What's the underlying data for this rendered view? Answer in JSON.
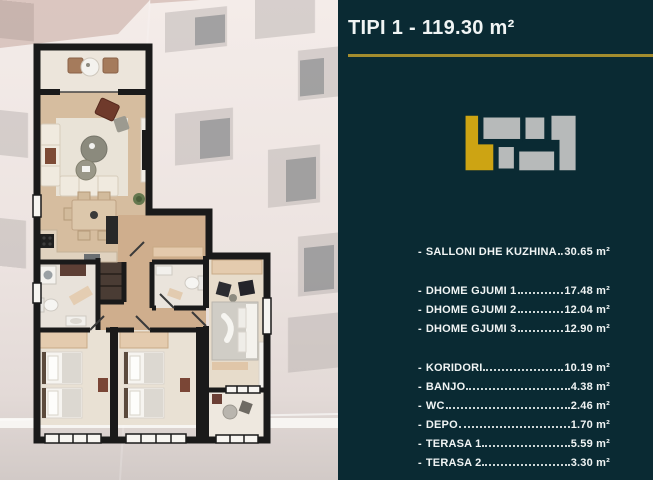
{
  "panel": {
    "title": "TIPI 1 - 119.30 m²",
    "list_bullet": "-",
    "background_color": "#0a2a33",
    "accent_color": "#a38c2e",
    "text_color": "#f0f4f4",
    "unit_icon": {
      "name": "building-footprint-unit-locator",
      "highlight_color": "#cda413",
      "block_color": "#b7baba"
    }
  },
  "floor_plan": {
    "description": "Top-down rendered floor plan of the apartment over a faded building facade photo"
  },
  "rooms": [
    {
      "label": "SALLONI DHE KUZHINA",
      "area": "30.65 m²",
      "gap_before": false
    },
    {
      "label": "DHOME GJUMI 1",
      "area": "17.48 m²",
      "gap_before": true
    },
    {
      "label": "DHOME GJUMI 2",
      "area": "12.04 m²",
      "gap_before": false
    },
    {
      "label": "DHOME GJUMI 3",
      "area": "12.90 m²",
      "gap_before": false
    },
    {
      "label": "KORIDORI",
      "area": "10.19 m²",
      "gap_before": true
    },
    {
      "label": "BANJO",
      "area": "4.38 m²",
      "gap_before": false
    },
    {
      "label": "WC",
      "area": "2.46 m²",
      "gap_before": false
    },
    {
      "label": "DEPO",
      "area": "1.70 m²",
      "gap_before": false
    },
    {
      "label": "TERASA 1",
      "area": "5.59 m²",
      "gap_before": false
    },
    {
      "label": "TERASA 2",
      "area": "3.30 m²",
      "gap_before": false
    }
  ]
}
